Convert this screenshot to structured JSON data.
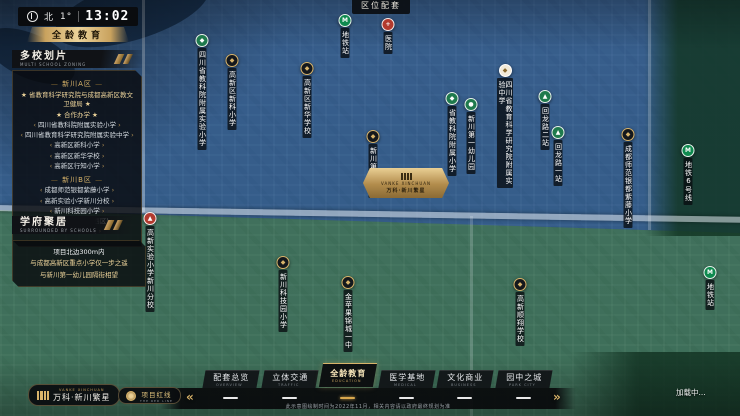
{
  "colors": {
    "accent_gold": "#d9b46a",
    "blue_zone": "#2a69b6",
    "green_zone": "#3e9460",
    "marker_green": "#1f7a4d",
    "marker_red": "#b23a2e"
  },
  "hud": {
    "north_label": "北",
    "degrees": "1°",
    "time": "13:02"
  },
  "page_banner": "全龄教育",
  "area_label": "区位配套",
  "panel_multi": {
    "title": "多校划片",
    "subtitle": "MULTI SCHOOL ZONING",
    "sections": [
      {
        "name": "新川A区",
        "notes": [
          "★ 省教育科学研究院与成都高新区教文卫健局 ★",
          "★ 合作办学 ★"
        ],
        "schools": [
          "四川省教科院附属实验小学",
          "四川省教育科学研究院附属实验中学",
          "高新区新科小学",
          "高新区新华学校",
          "高新区行知小学"
        ]
      },
      {
        "name": "新川B区",
        "notes": [],
        "schools": [
          "成都师范银都紫藤小学",
          "高新实验小学新川分校",
          "新川科技园小学",
          "金苹果锦城一中(西区)",
          "高新顺翔学校"
        ]
      }
    ]
  },
  "panel_scholar": {
    "title": "学府聚居",
    "subtitle": "SURROUNDED BY SCHOOLS",
    "lines": [
      "项目北边300m内",
      "与成都高新区重点小学仅一步之遥",
      "与新川第一幼儿园隔街相望"
    ]
  },
  "plaque": {
    "eng": "VANKE XINCHUAN",
    "cn": "万科·新川繁星"
  },
  "markers": [
    {
      "type": "metro",
      "glyph": "M",
      "label": "地铁站",
      "x": 345,
      "y": 14
    },
    {
      "type": "hospital",
      "glyph": "+",
      "label": "医院",
      "x": 388,
      "y": 18
    },
    {
      "type": "school-green",
      "glyph": "◆",
      "label": "四川省教科院附属实验小学",
      "x": 202,
      "y": 34
    },
    {
      "type": "school-dark",
      "glyph": "◆",
      "label": "高新区新科小学",
      "x": 232,
      "y": 54
    },
    {
      "type": "school-dark",
      "glyph": "◆",
      "label": "高新区新华学校",
      "x": 307,
      "y": 62
    },
    {
      "type": "school-dark",
      "glyph": "◆",
      "label": "新川第一小学",
      "x": 373,
      "y": 130
    },
    {
      "type": "school-green",
      "glyph": "◆",
      "label": "省教科院附属小学",
      "x": 452,
      "y": 92
    },
    {
      "type": "kinder-green",
      "glyph": "●",
      "label": "新川第一幼儿园",
      "x": 471,
      "y": 98
    },
    {
      "type": "school-white",
      "glyph": "◆",
      "label": "四川省教育科学研究院附属实验中学",
      "x": 505,
      "y": 64
    },
    {
      "type": "station-green",
      "glyph": "▲",
      "label": "回龙路二站",
      "x": 545,
      "y": 90
    },
    {
      "type": "station-green",
      "glyph": "▲",
      "label": "回龙路一站",
      "x": 558,
      "y": 126
    },
    {
      "type": "school-dark",
      "glyph": "◆",
      "label": "成都师范银都紫藤小学",
      "x": 628,
      "y": 128
    },
    {
      "type": "metro",
      "glyph": "M",
      "label": "地铁6号线",
      "x": 688,
      "y": 144
    },
    {
      "type": "hospital",
      "glyph": "▲",
      "label": "高新实验小学新川分校",
      "x": 150,
      "y": 212
    },
    {
      "type": "school-dark",
      "glyph": "◆",
      "label": "新川科技园小学",
      "x": 283,
      "y": 256
    },
    {
      "type": "school-dark",
      "glyph": "◆",
      "label": "金苹果锦城一中",
      "x": 348,
      "y": 276
    },
    {
      "type": "school-dark",
      "glyph": "◆",
      "label": "高新顺翔学校",
      "x": 520,
      "y": 278
    },
    {
      "type": "metro",
      "glyph": "M",
      "label": "地铁站",
      "x": 710,
      "y": 266
    }
  ],
  "bottom_bar": {
    "prev_arrow": "«",
    "next_arrow": "»",
    "tabs": [
      {
        "label": "配套总览",
        "sub": "OVERVIEW",
        "active": false
      },
      {
        "label": "立体交通",
        "sub": "TRAFFIC",
        "active": false
      },
      {
        "label": "全龄教育",
        "sub": "EDUCATION",
        "active": true
      },
      {
        "label": "医学基地",
        "sub": "MEDICAL",
        "active": false
      },
      {
        "label": "文化商业",
        "sub": "BUSINESS",
        "active": false
      },
      {
        "label": "园中之城",
        "sub": "PARK CITY",
        "active": false
      }
    ],
    "disclaimer": "此示意图绘制时间为2022年11月，相关内容请以政府最终规划为准"
  },
  "footer": {
    "logo_eng": "VANKE XINCHUAN",
    "logo_cn": "万科·新川繁星",
    "redline_cn": "项目红线",
    "redline_eng": "THE RED LINE"
  },
  "status": {
    "loading": "加载中..."
  }
}
